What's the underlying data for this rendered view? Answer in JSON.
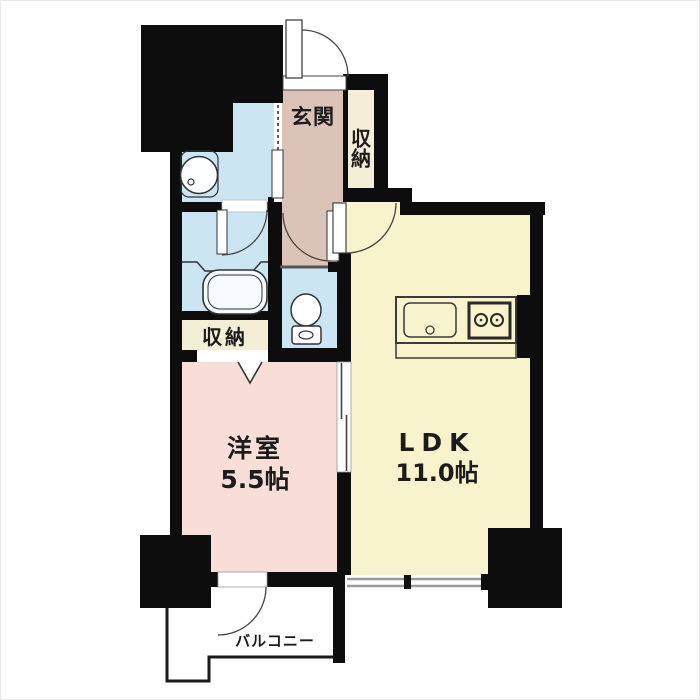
{
  "plan": {
    "type": "Japanese apartment floor plan (1LDK)",
    "labels": {
      "genkan": "玄関",
      "storage_top": "収納",
      "storage_mid": "収納",
      "western_room_name": "洋室",
      "western_room_size": "5.5帖",
      "ldk_name": "LDK",
      "ldk_size": "11.0帖",
      "balcony": "バルコニー"
    },
    "colors": {
      "wall": "#0d0d0d",
      "hall_floor": "#dbc3b8",
      "wet_area_floor": "#cbe5f3",
      "western_room_floor": "#f9ded7",
      "ldk_floor": "#f8f3cd",
      "storage_floor": "#f4eed7",
      "balcony_floor": "#ffffff",
      "fixture_outline": "#333333",
      "window_line": "#9a9a9a"
    }
  }
}
